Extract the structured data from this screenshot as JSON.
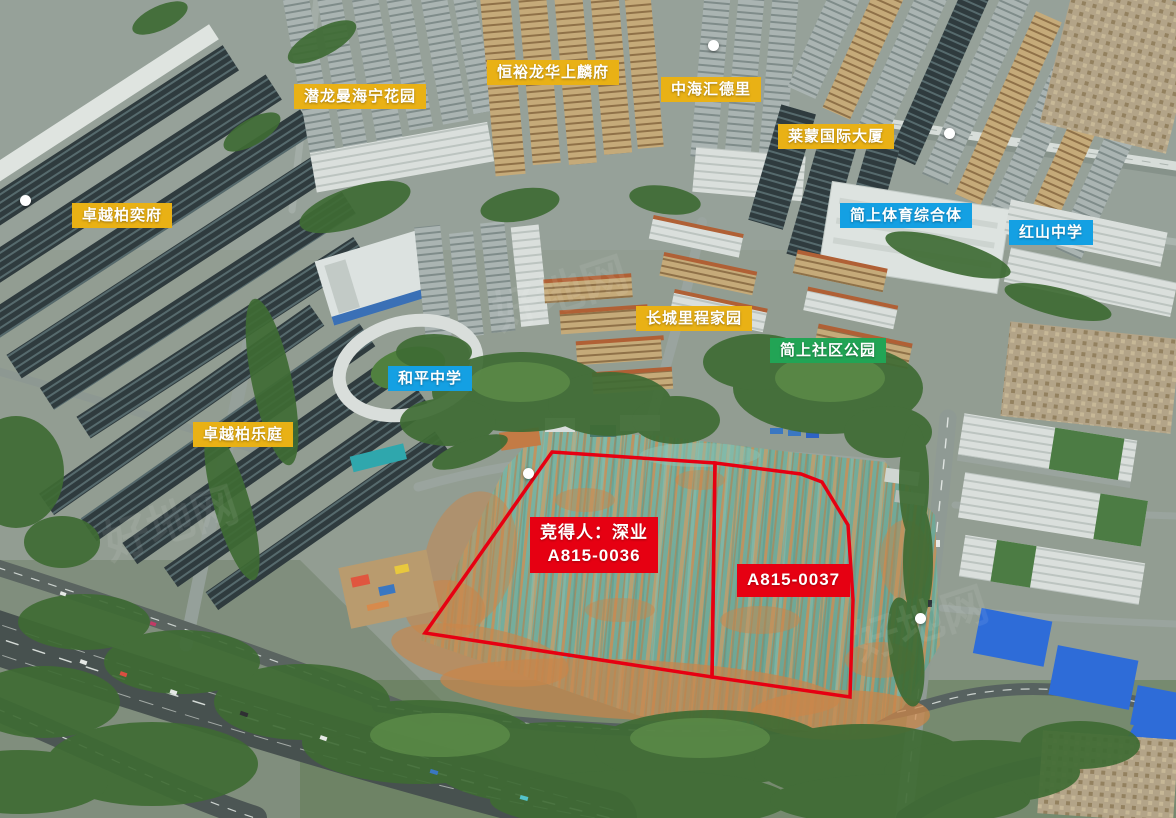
{
  "image_labels": {
    "residential": {
      "qianlong_manhaining_garden": "潜龙曼海宁花园",
      "hengyu_longhua_shanglinfu": "恒裕龙华上麟府",
      "zhonghai_huideli": "中海汇德里",
      "laimeng_international_tower": "莱蒙国际大厦",
      "zhuoyue_boyifu": "卓越柏奕府",
      "changcheng_licheng_jiayuan": "长城里程家园",
      "zhuoyue_boleting": "卓越柏乐庭"
    },
    "public_facilities": {
      "jianshang_sports_complex": "简上体育综合体",
      "hongshan_middle_school": "红山中学",
      "heping_middle_school": "和平中学"
    },
    "parks": {
      "jianshang_community_park": "简上社区公园"
    },
    "parcels": {
      "winner_line1": "竞得人：深业",
      "winner_line2": "A815-0036",
      "parcel_b_label": "A815-0037"
    },
    "watermark": "好地网"
  },
  "colors": {
    "residential_label_bg": "#e9b115",
    "public_label_bg": "#14a0e3",
    "park_label_bg": "#22a455",
    "parcel_label_bg": "#e60012",
    "parcel_outline": "#e60012",
    "label_text": "#ffffff"
  }
}
